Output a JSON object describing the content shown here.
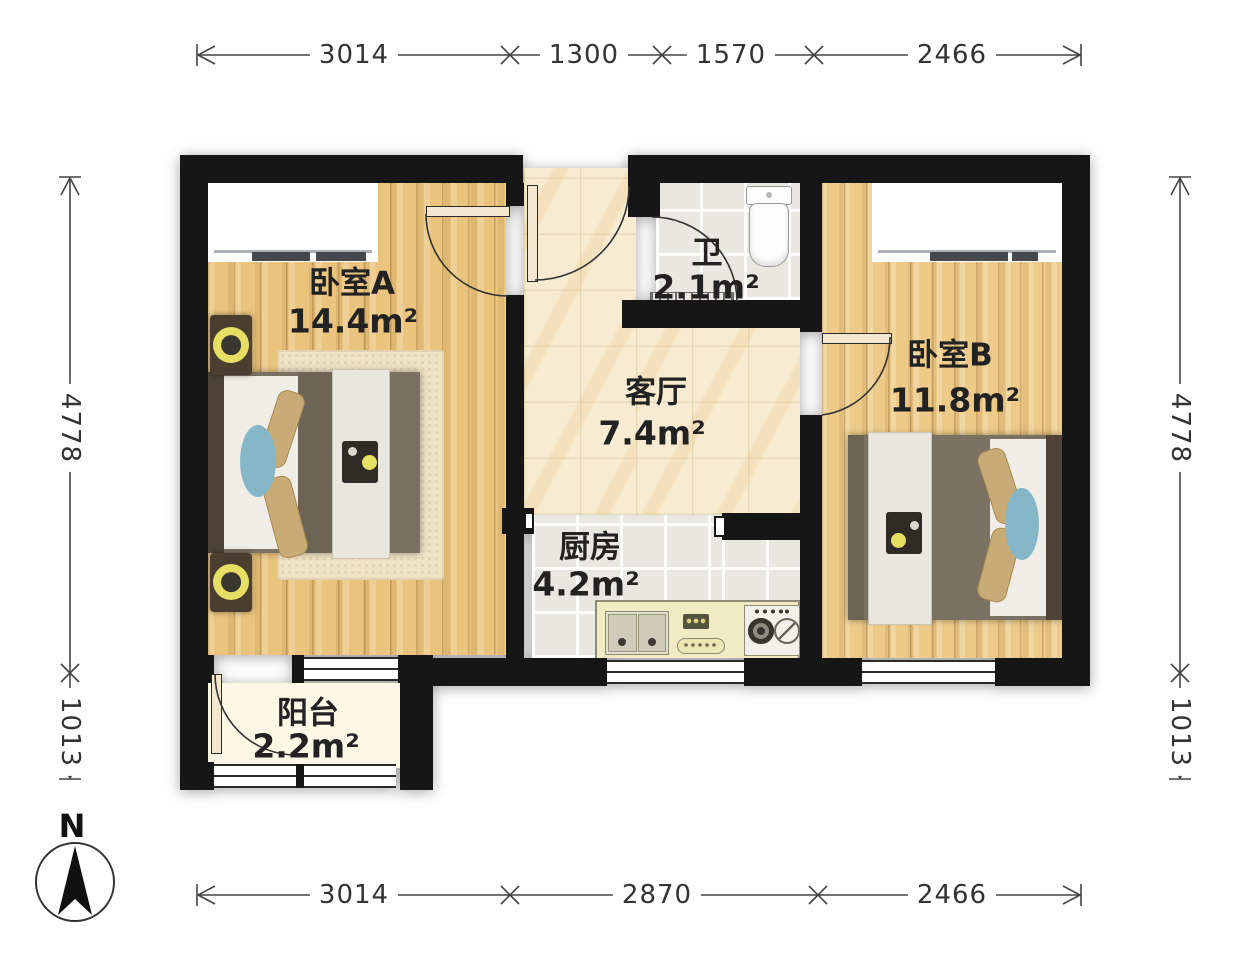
{
  "rooms": {
    "bedroom_a": {
      "name": "卧室A",
      "area": "14.4m²"
    },
    "bedroom_b": {
      "name": "卧室B",
      "area": "11.8m²"
    },
    "living_room": {
      "name": "客厅",
      "area": "7.4m²"
    },
    "kitchen": {
      "name": "厨房",
      "area": "4.2m²"
    },
    "bathroom": {
      "name": "卫",
      "area": "2.1m²"
    },
    "balcony": {
      "name": "阳台",
      "area": "2.2m²"
    }
  },
  "dimensions_mm": {
    "top": [
      "3014",
      "1300",
      "1570",
      "2466"
    ],
    "bottom": [
      "3014",
      "2870",
      "2466"
    ],
    "left": [
      "4778",
      "1013"
    ],
    "right": [
      "4778",
      "1013"
    ]
  },
  "compass": {
    "north_label": "N"
  },
  "colors": {
    "wall": "#161616",
    "wood_floor": "#eac47d",
    "marble_floor": "#f7ecd2",
    "tile_floor": "#e9e7e1",
    "balcony_floor": "#fbf8e6",
    "bed_duvet": "#7a7060",
    "accent_blue": "#86b7c8",
    "lamp_yellow": "#e6df63",
    "counter": "#f1ebc4"
  }
}
